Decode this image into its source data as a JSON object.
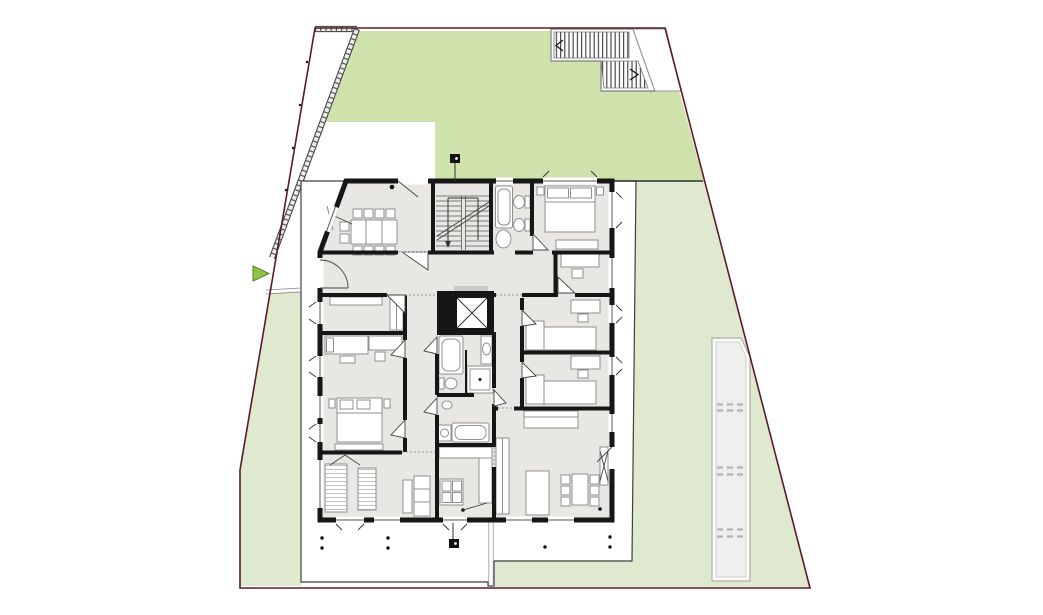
{
  "title": "Architectural site and floor plan drawing (ground floor with gardens)",
  "colors": {
    "page_bg": "#ffffff",
    "green_top": "#cfe2ab",
    "green_main": "#dfe9cf",
    "boundary": "#5a1a28",
    "wall": "#161616",
    "floor": "#e8e7e4",
    "terrace": "#ffffff",
    "terrace_line": "#3f3f3f",
    "furniture_fill": "#ffffff",
    "furniture_stroke": "#8f8f8f",
    "ramp_fill": "#efefed",
    "ramp_frame": "#b0b0a8",
    "entrance_arrow": "#8fc34a",
    "entrance_arrow_edge": "#55801f",
    "dot": "#111111"
  },
  "markers": {
    "entrance_arrow": "green triangle pointing right at west boundary",
    "section_marker_top": "small black square flag above building",
    "section_marker_bottom": "small black square flag below building",
    "elevator": "crossed-box elevator symbol",
    "stair_arrow": "down arrow on left stair flight"
  },
  "site": {
    "areas": [
      "north-garden",
      "west-garden",
      "east-garden",
      "paved-terrace",
      "roof-deck-stairs",
      "garage-ramp",
      "footpath",
      "boundary-fence"
    ],
    "building_rooms": [
      "meeting-room",
      "staircase",
      "bathroom-north",
      "bedroom-northeast",
      "corridor",
      "elevator",
      "bedroom-east-1",
      "bedroom-east-2",
      "bedroom-east-3",
      "bedroom-west-1",
      "bedroom-west-2",
      "bedroom-west-3",
      "bathroom-center-1",
      "bathroom-center-2",
      "kitchen",
      "living-room-southwest",
      "living-room-southeast",
      "hall"
    ]
  }
}
